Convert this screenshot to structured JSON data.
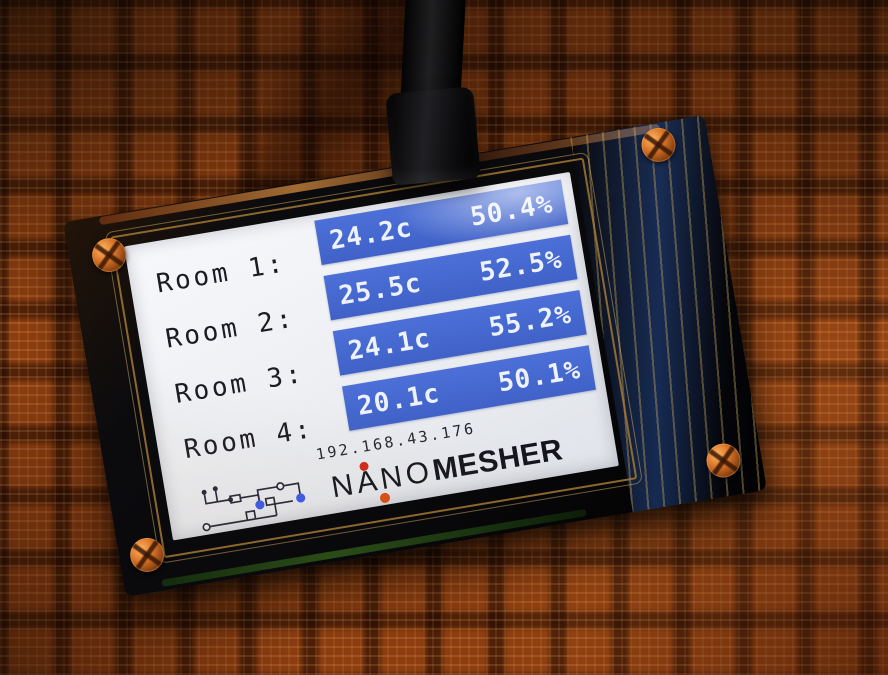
{
  "screen": {
    "rooms": [
      {
        "label": "Room 1:",
        "temp": "24.2c",
        "humidity": "50.4%"
      },
      {
        "label": "Room 2:",
        "temp": "25.5c",
        "humidity": "52.5%"
      },
      {
        "label": "Room 3:",
        "temp": "24.1c",
        "humidity": "55.2%"
      },
      {
        "label": "Room 4:",
        "temp": "20.1c",
        "humidity": "50.1%"
      }
    ],
    "ip_address": "192.168.43.176",
    "brand": {
      "first": "NANO",
      "second": "MESHER"
    }
  },
  "icons": {
    "logo": "circuit-schematic-icon",
    "screws": "phillips-screw-icon",
    "cable": "usb-cable"
  },
  "colors": {
    "reading_box_blue": "#4468cf",
    "reading_text": "#eef2ff",
    "screen_background": "#edeff3",
    "label_text": "#1b1b22",
    "brand_text": "#15151d",
    "logo_dot_red": "#d0291a",
    "logo_dot_orange": "#d84d12",
    "logo_node_blue": "#3a57e8",
    "basket_orange": "#a64d16"
  }
}
